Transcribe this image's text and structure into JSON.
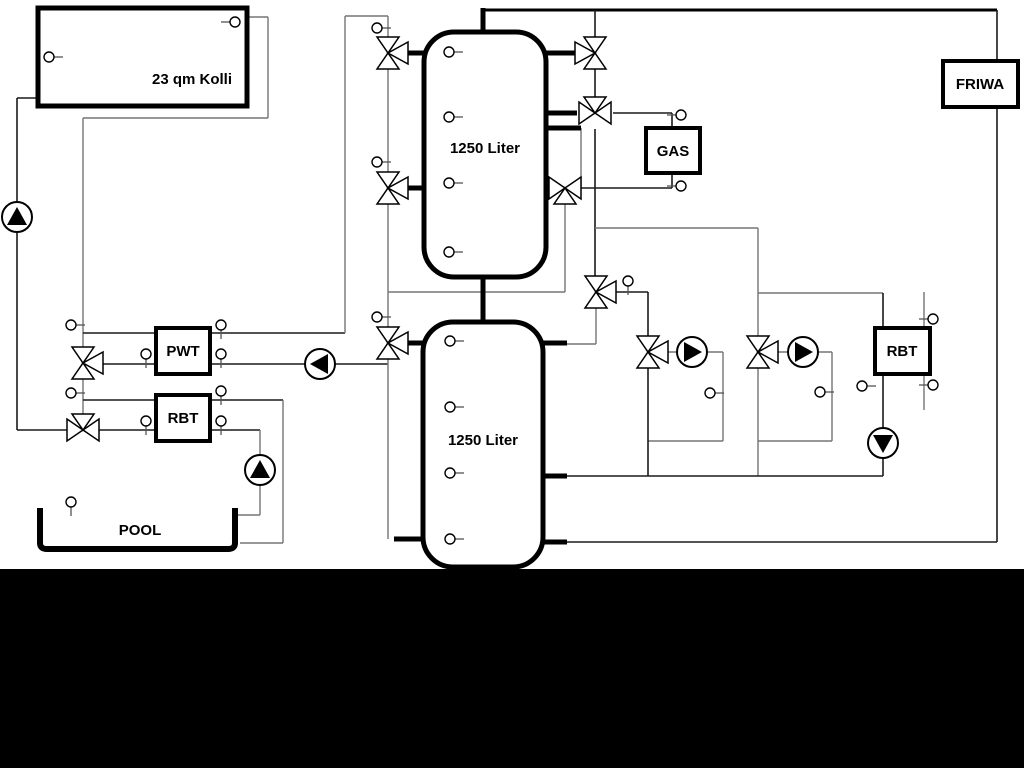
{
  "labels": {
    "collector": "23 qm Kolli",
    "tank_top": "1250 Liter",
    "tank_bottom": "1250 Liter",
    "pwt": "PWT",
    "rbt_left": "RBT",
    "gas": "GAS",
    "friwa": "FRIWA",
    "rbt_right": "RBT",
    "pool": "POOL"
  },
  "colors": {
    "background": "#ffffff",
    "pipe_gray": "#757575",
    "pipe_black": "#1a1a1a",
    "component": "#000000",
    "bottom_band": "#000000"
  }
}
